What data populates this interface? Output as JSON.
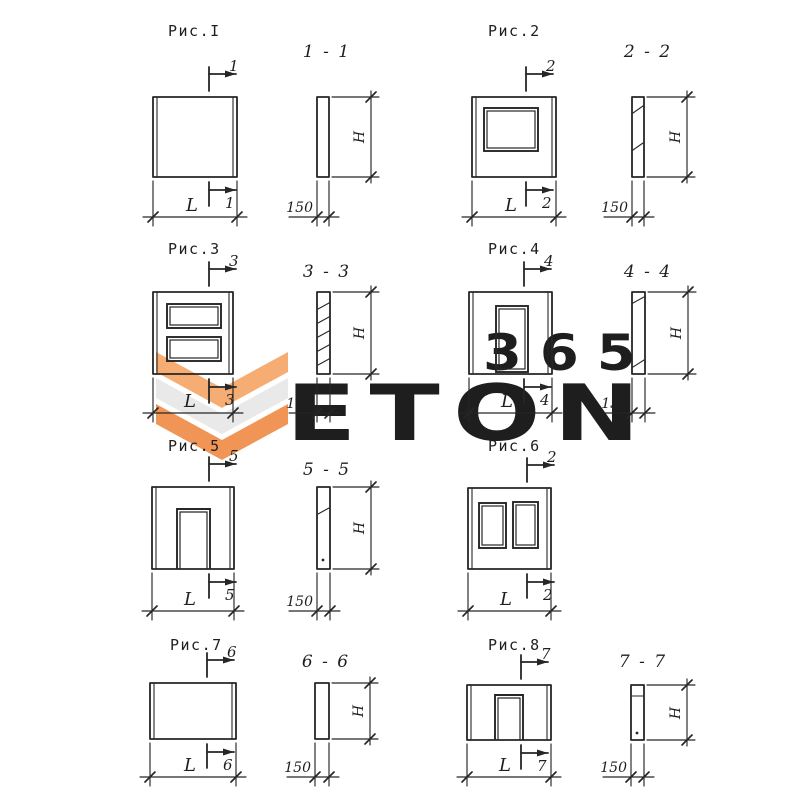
{
  "labels": {
    "length": "L",
    "height": "H",
    "thickness": "150"
  },
  "watermark": {
    "word": "ETON",
    "number": "365",
    "word_color": "#e4e4e4",
    "number_color": "#f8c09b",
    "logo_orange_light": "#f6ad74",
    "logo_gray": "#e9e9e9",
    "logo_orange": "#f19556"
  },
  "figures": [
    {
      "title": "Рис.I",
      "cut_number": "1",
      "section_title": "1 - 1"
    },
    {
      "title": "Рис.2",
      "cut_number": "2",
      "section_title": "2 - 2"
    },
    {
      "title": "Рис.3",
      "cut_number": "3",
      "section_title": "3 - 3"
    },
    {
      "title": "Рис.4",
      "cut_number": "4",
      "section_title": "4 - 4"
    },
    {
      "title": "Рис.5",
      "cut_number": "5",
      "section_title": "5 - 5"
    },
    {
      "title": "Рис.6",
      "cut_number": "2"
    },
    {
      "title": "Рис.7",
      "cut_number": "6",
      "section_title": "6 - 6"
    },
    {
      "title": "Рис.8",
      "cut_number": "7",
      "section_title": "7 - 7"
    }
  ]
}
